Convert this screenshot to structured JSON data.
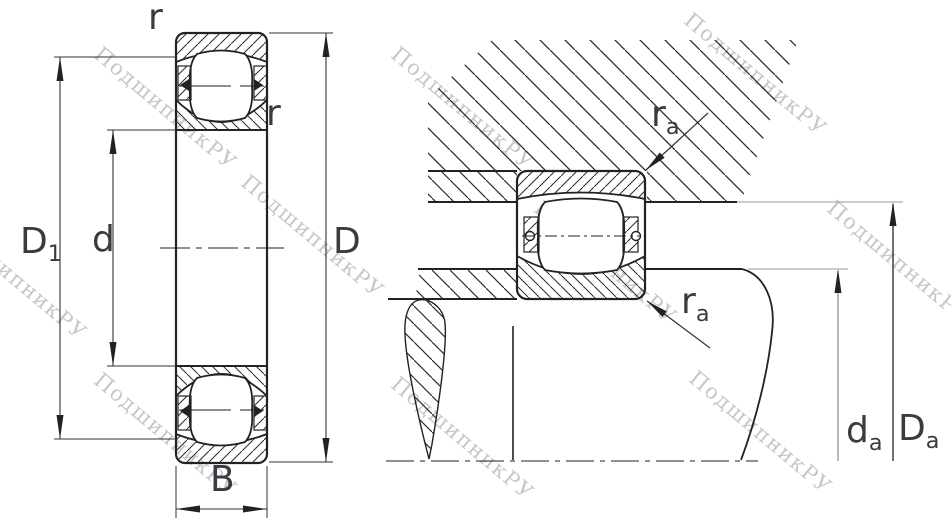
{
  "page": {
    "background": "#ffffff",
    "description": "bearing technical drawing"
  },
  "watermark": {
    "text": "ПодшипникРУ",
    "color": "#c6c6cd"
  },
  "drawing": {
    "line_color": "#222222",
    "label_color": "#3a3a40",
    "hatch_color": "#2b2b2b"
  },
  "left_view": {
    "name": "bearing-cross-section",
    "labels": {
      "r_top": "r",
      "r_side": "r",
      "outer_diameter_1": {
        "main": "D",
        "sub": "1"
      },
      "bore_diameter": "d",
      "outer_diameter": "D",
      "width": "B"
    }
  },
  "right_view": {
    "name": "mounting-abutment-section",
    "labels": {
      "fillet_top": {
        "main": "r",
        "sub": "a"
      },
      "fillet_bottom": {
        "main": "r",
        "sub": "a"
      },
      "shaft_abutment": {
        "main": "d",
        "sub": "a"
      },
      "housing_abutment": {
        "main": "D",
        "sub": "a"
      }
    }
  }
}
